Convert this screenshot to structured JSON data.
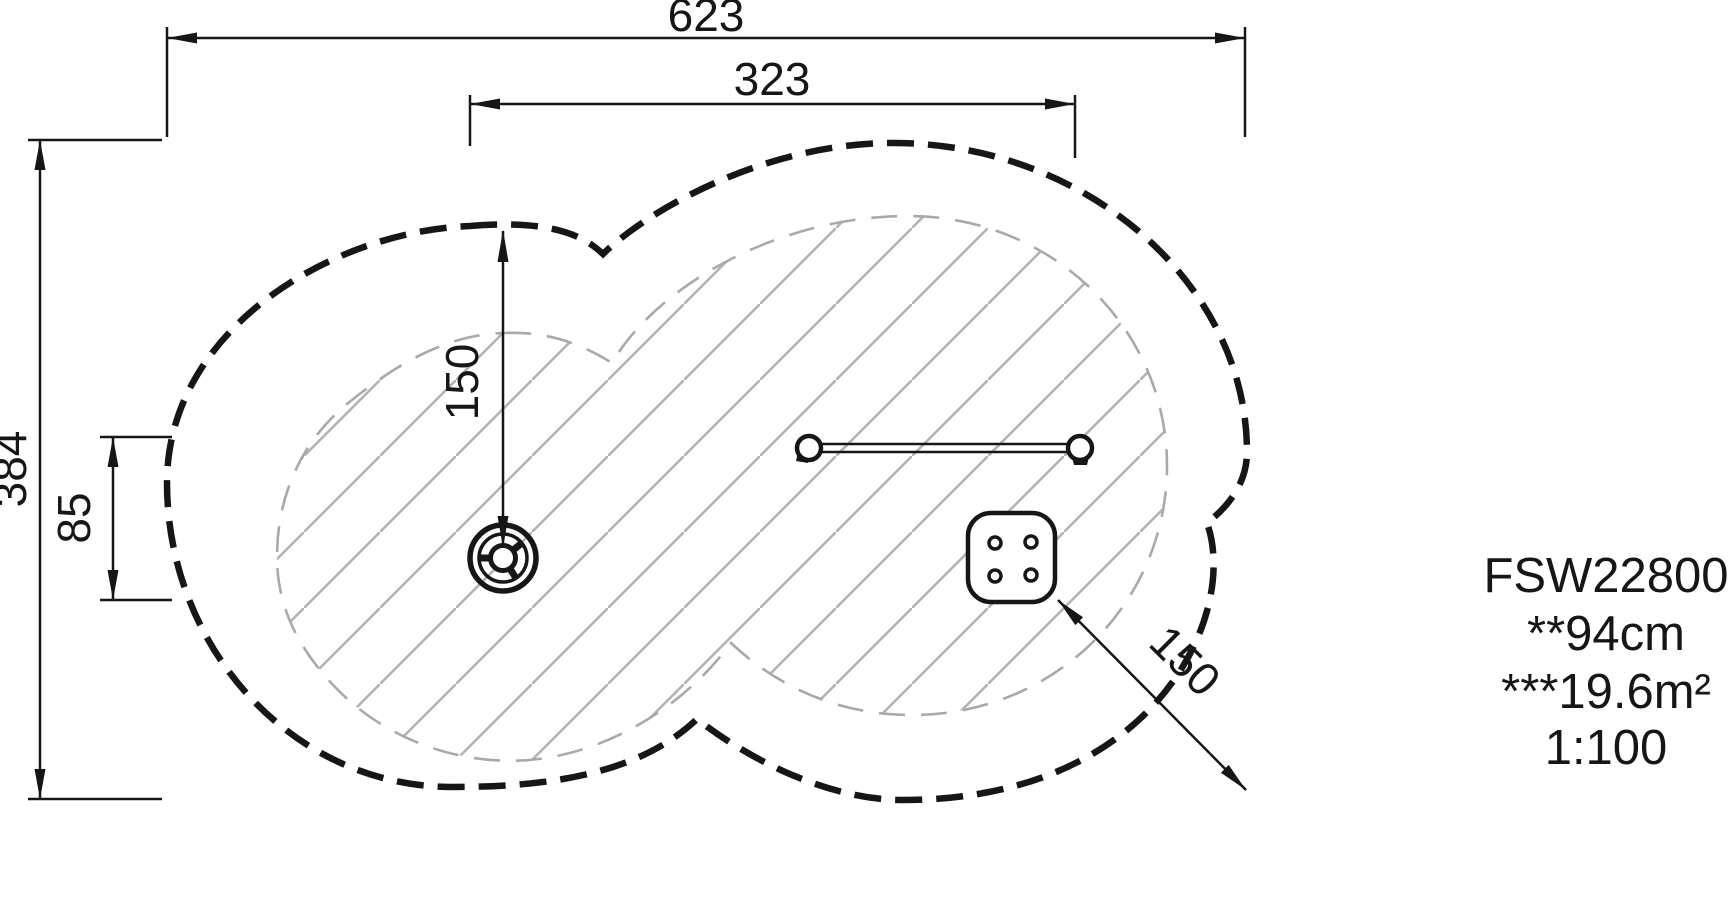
{
  "title_block": {
    "product_code": "FSW22800",
    "fall_height": "**94cm",
    "safety_area": "***19.6m²",
    "scale": "1:100"
  },
  "dimensions": {
    "total_width": "623",
    "inner_width": "323",
    "total_height": "384",
    "left_offset": "85",
    "clearance_vertical": "150",
    "clearance_diagonal": "150"
  },
  "symbols": {
    "steering_wheel": "play-panel-steering-wheel",
    "balance_beam": "balance-beam-top-view",
    "spring_platform": "spring-platform-top-view"
  },
  "colors": {
    "line": "#161616",
    "hatch": "#b4b4b4",
    "inner_dash": "#a9a9a9",
    "background": "#ffffff"
  }
}
